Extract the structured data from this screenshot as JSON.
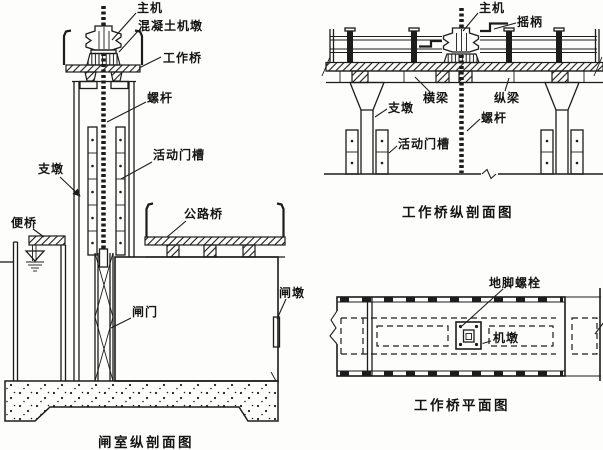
{
  "page": {
    "ink_color": "#1c1c1c",
    "paper_color": "#fdfdfb"
  },
  "figures": {
    "lock_chamber": {
      "caption": "闸室纵剖面图",
      "labels": {
        "main_hoist": "主机",
        "concrete_machine_pier": "混凝土机墩",
        "working_bridge": "工作桥",
        "screw_rod": "螺杆",
        "support_pier": "支墩",
        "movable_gate_slot": "活动门槽",
        "temporary_bridge": "便桥",
        "highway_bridge": "公路桥",
        "gate": "闸门",
        "gate_pier": "闸墩"
      }
    },
    "bridge_section": {
      "caption": "工作桥纵剖面图",
      "labels": {
        "main_hoist": "主机",
        "crank_handle": "摇柄",
        "support_pier": "支墩",
        "cross_beam": "横梁",
        "longitudinal_beam": "纵梁",
        "screw_rod": "螺杆",
        "movable_gate_slot": "活动门槽"
      }
    },
    "bridge_plan": {
      "caption": "工作桥平面图",
      "labels": {
        "anchor_bolt": "地脚螺栓",
        "machine_pier": "机墩"
      }
    }
  }
}
